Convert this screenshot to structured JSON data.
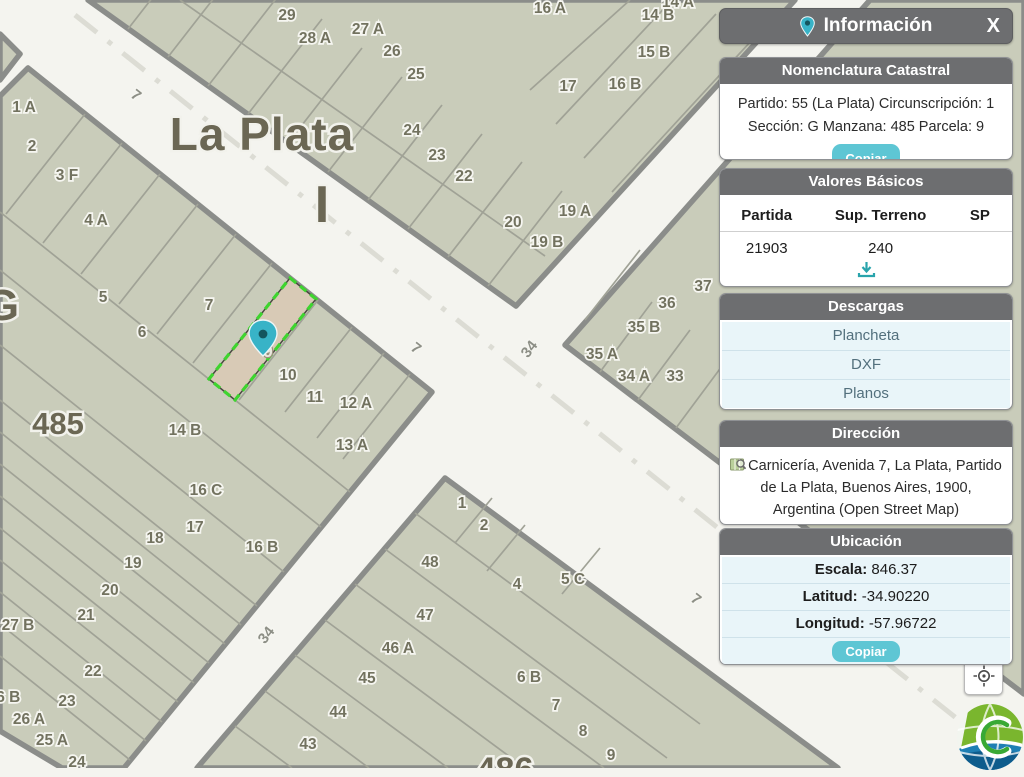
{
  "panel": {
    "title": "Información",
    "close_label": "X",
    "nomenclatura": {
      "title": "Nomenclatura Catastral",
      "line1": "Partido: 55 (La Plata) Circunscripción: 1",
      "line2": "Sección: G Manzana: 485 Parcela: 9",
      "copy_label": "Copiar"
    },
    "valores": {
      "title": "Valores Básicos",
      "headers": [
        "Partida",
        "Sup. Terreno",
        "SP"
      ],
      "row": [
        "21903",
        "240",
        ""
      ]
    },
    "descargas": {
      "title": "Descargas",
      "items": [
        "Plancheta",
        "DXF",
        "Planos"
      ]
    },
    "direccion": {
      "title": "Dirección",
      "text": "Carnicería, Avenida 7, La Plata, Partido de La Plata, Buenos Aires, 1900, Argentina (Open Street Map)"
    },
    "ubicacion": {
      "title": "Ubicación",
      "rows": [
        {
          "label": "Escala:",
          "value": "846.37"
        },
        {
          "label": "Latitud:",
          "value": "-34.90220"
        },
        {
          "label": "Longitud:",
          "value": "-57.96722"
        }
      ],
      "copy_label": "Copiar"
    }
  },
  "map": {
    "city_label": "La Plata",
    "roman_label": "I",
    "section_letter": "G",
    "block_number": "485",
    "block_number_south": "486",
    "selected_parcel_label": "9",
    "colors": {
      "block": "#c9ccba",
      "street": "#f4f4ef",
      "selected_fill": "#d8cab6",
      "selected_stroke": "#3ed42f",
      "pin": "#38b3c7",
      "accent": "#5ec6d4"
    },
    "street_labels": [
      {
        "t": "7",
        "x": 133,
        "y": 99,
        "r": 38
      },
      {
        "t": "7",
        "x": 413,
        "y": 352,
        "r": 38
      },
      {
        "t": "7",
        "x": 693,
        "y": 603,
        "r": 38
      },
      {
        "t": "34",
        "x": 533,
        "y": 352,
        "r": -52
      },
      {
        "t": "34",
        "x": 270,
        "y": 638,
        "r": -52
      }
    ],
    "parcel_labels": [
      {
        "t": "29",
        "x": 287,
        "y": 15
      },
      {
        "t": "28 A",
        "x": 315,
        "y": 38
      },
      {
        "t": "27 A",
        "x": 368,
        "y": 29
      },
      {
        "t": "26",
        "x": 392,
        "y": 51
      },
      {
        "t": "25",
        "x": 416,
        "y": 74
      },
      {
        "t": "24",
        "x": 412,
        "y": 130
      },
      {
        "t": "23",
        "x": 437,
        "y": 155
      },
      {
        "t": "22",
        "x": 464,
        "y": 176
      },
      {
        "t": "20",
        "x": 513,
        "y": 222
      },
      {
        "t": "19 A",
        "x": 575,
        "y": 211
      },
      {
        "t": "19 B",
        "x": 547,
        "y": 242
      },
      {
        "t": "17",
        "x": 568,
        "y": 86
      },
      {
        "t": "16 A",
        "x": 550,
        "y": 8
      },
      {
        "t": "16 B",
        "x": 625,
        "y": 84
      },
      {
        "t": "15 B",
        "x": 654,
        "y": 52
      },
      {
        "t": "14 B",
        "x": 658,
        "y": 15
      },
      {
        "t": "14 A",
        "x": 678,
        "y": 2
      },
      {
        "t": "1 A",
        "x": 24,
        "y": 107
      },
      {
        "t": "2",
        "x": 32,
        "y": 146
      },
      {
        "t": "3 F",
        "x": 67,
        "y": 175
      },
      {
        "t": "4 A",
        "x": 96,
        "y": 220
      },
      {
        "t": "5",
        "x": 103,
        "y": 297
      },
      {
        "t": "6",
        "x": 142,
        "y": 332
      },
      {
        "t": "7",
        "x": 209,
        "y": 305
      },
      {
        "t": "10",
        "x": 288,
        "y": 375
      },
      {
        "t": "11",
        "x": 315,
        "y": 397
      },
      {
        "t": "12 A",
        "x": 356,
        "y": 403
      },
      {
        "t": "13 A",
        "x": 352,
        "y": 445
      },
      {
        "t": "14 B",
        "x": 185,
        "y": 430
      },
      {
        "t": "16 C",
        "x": 206,
        "y": 490
      },
      {
        "t": "16 B",
        "x": 262,
        "y": 547
      },
      {
        "t": "17",
        "x": 195,
        "y": 527
      },
      {
        "t": "18",
        "x": 155,
        "y": 538
      },
      {
        "t": "19",
        "x": 133,
        "y": 563
      },
      {
        "t": "20",
        "x": 110,
        "y": 590
      },
      {
        "t": "21",
        "x": 86,
        "y": 615
      },
      {
        "t": "27 B",
        "x": 18,
        "y": 625
      },
      {
        "t": "22",
        "x": 93,
        "y": 671
      },
      {
        "t": "23",
        "x": 67,
        "y": 701
      },
      {
        "t": "26 B",
        "x": 4,
        "y": 697
      },
      {
        "t": "26 A",
        "x": 29,
        "y": 719
      },
      {
        "t": "25 A",
        "x": 52,
        "y": 740
      },
      {
        "t": "24",
        "x": 77,
        "y": 762
      },
      {
        "t": "37",
        "x": 703,
        "y": 286
      },
      {
        "t": "36",
        "x": 667,
        "y": 303
      },
      {
        "t": "35 B",
        "x": 644,
        "y": 327
      },
      {
        "t": "35 A",
        "x": 602,
        "y": 354
      },
      {
        "t": "34 A",
        "x": 634,
        "y": 376
      },
      {
        "t": "33",
        "x": 675,
        "y": 376
      },
      {
        "t": "1",
        "x": 462,
        "y": 503
      },
      {
        "t": "2",
        "x": 484,
        "y": 525
      },
      {
        "t": "48",
        "x": 430,
        "y": 562
      },
      {
        "t": "4",
        "x": 517,
        "y": 584
      },
      {
        "t": "5 C",
        "x": 573,
        "y": 579
      },
      {
        "t": "47",
        "x": 425,
        "y": 615
      },
      {
        "t": "46 A",
        "x": 398,
        "y": 648
      },
      {
        "t": "45",
        "x": 367,
        "y": 678
      },
      {
        "t": "44",
        "x": 338,
        "y": 712
      },
      {
        "t": "43",
        "x": 308,
        "y": 744
      },
      {
        "t": "6 B",
        "x": 529,
        "y": 677
      },
      {
        "t": "7",
        "x": 556,
        "y": 705
      },
      {
        "t": "8",
        "x": 583,
        "y": 731
      },
      {
        "t": "9",
        "x": 611,
        "y": 755
      }
    ]
  }
}
